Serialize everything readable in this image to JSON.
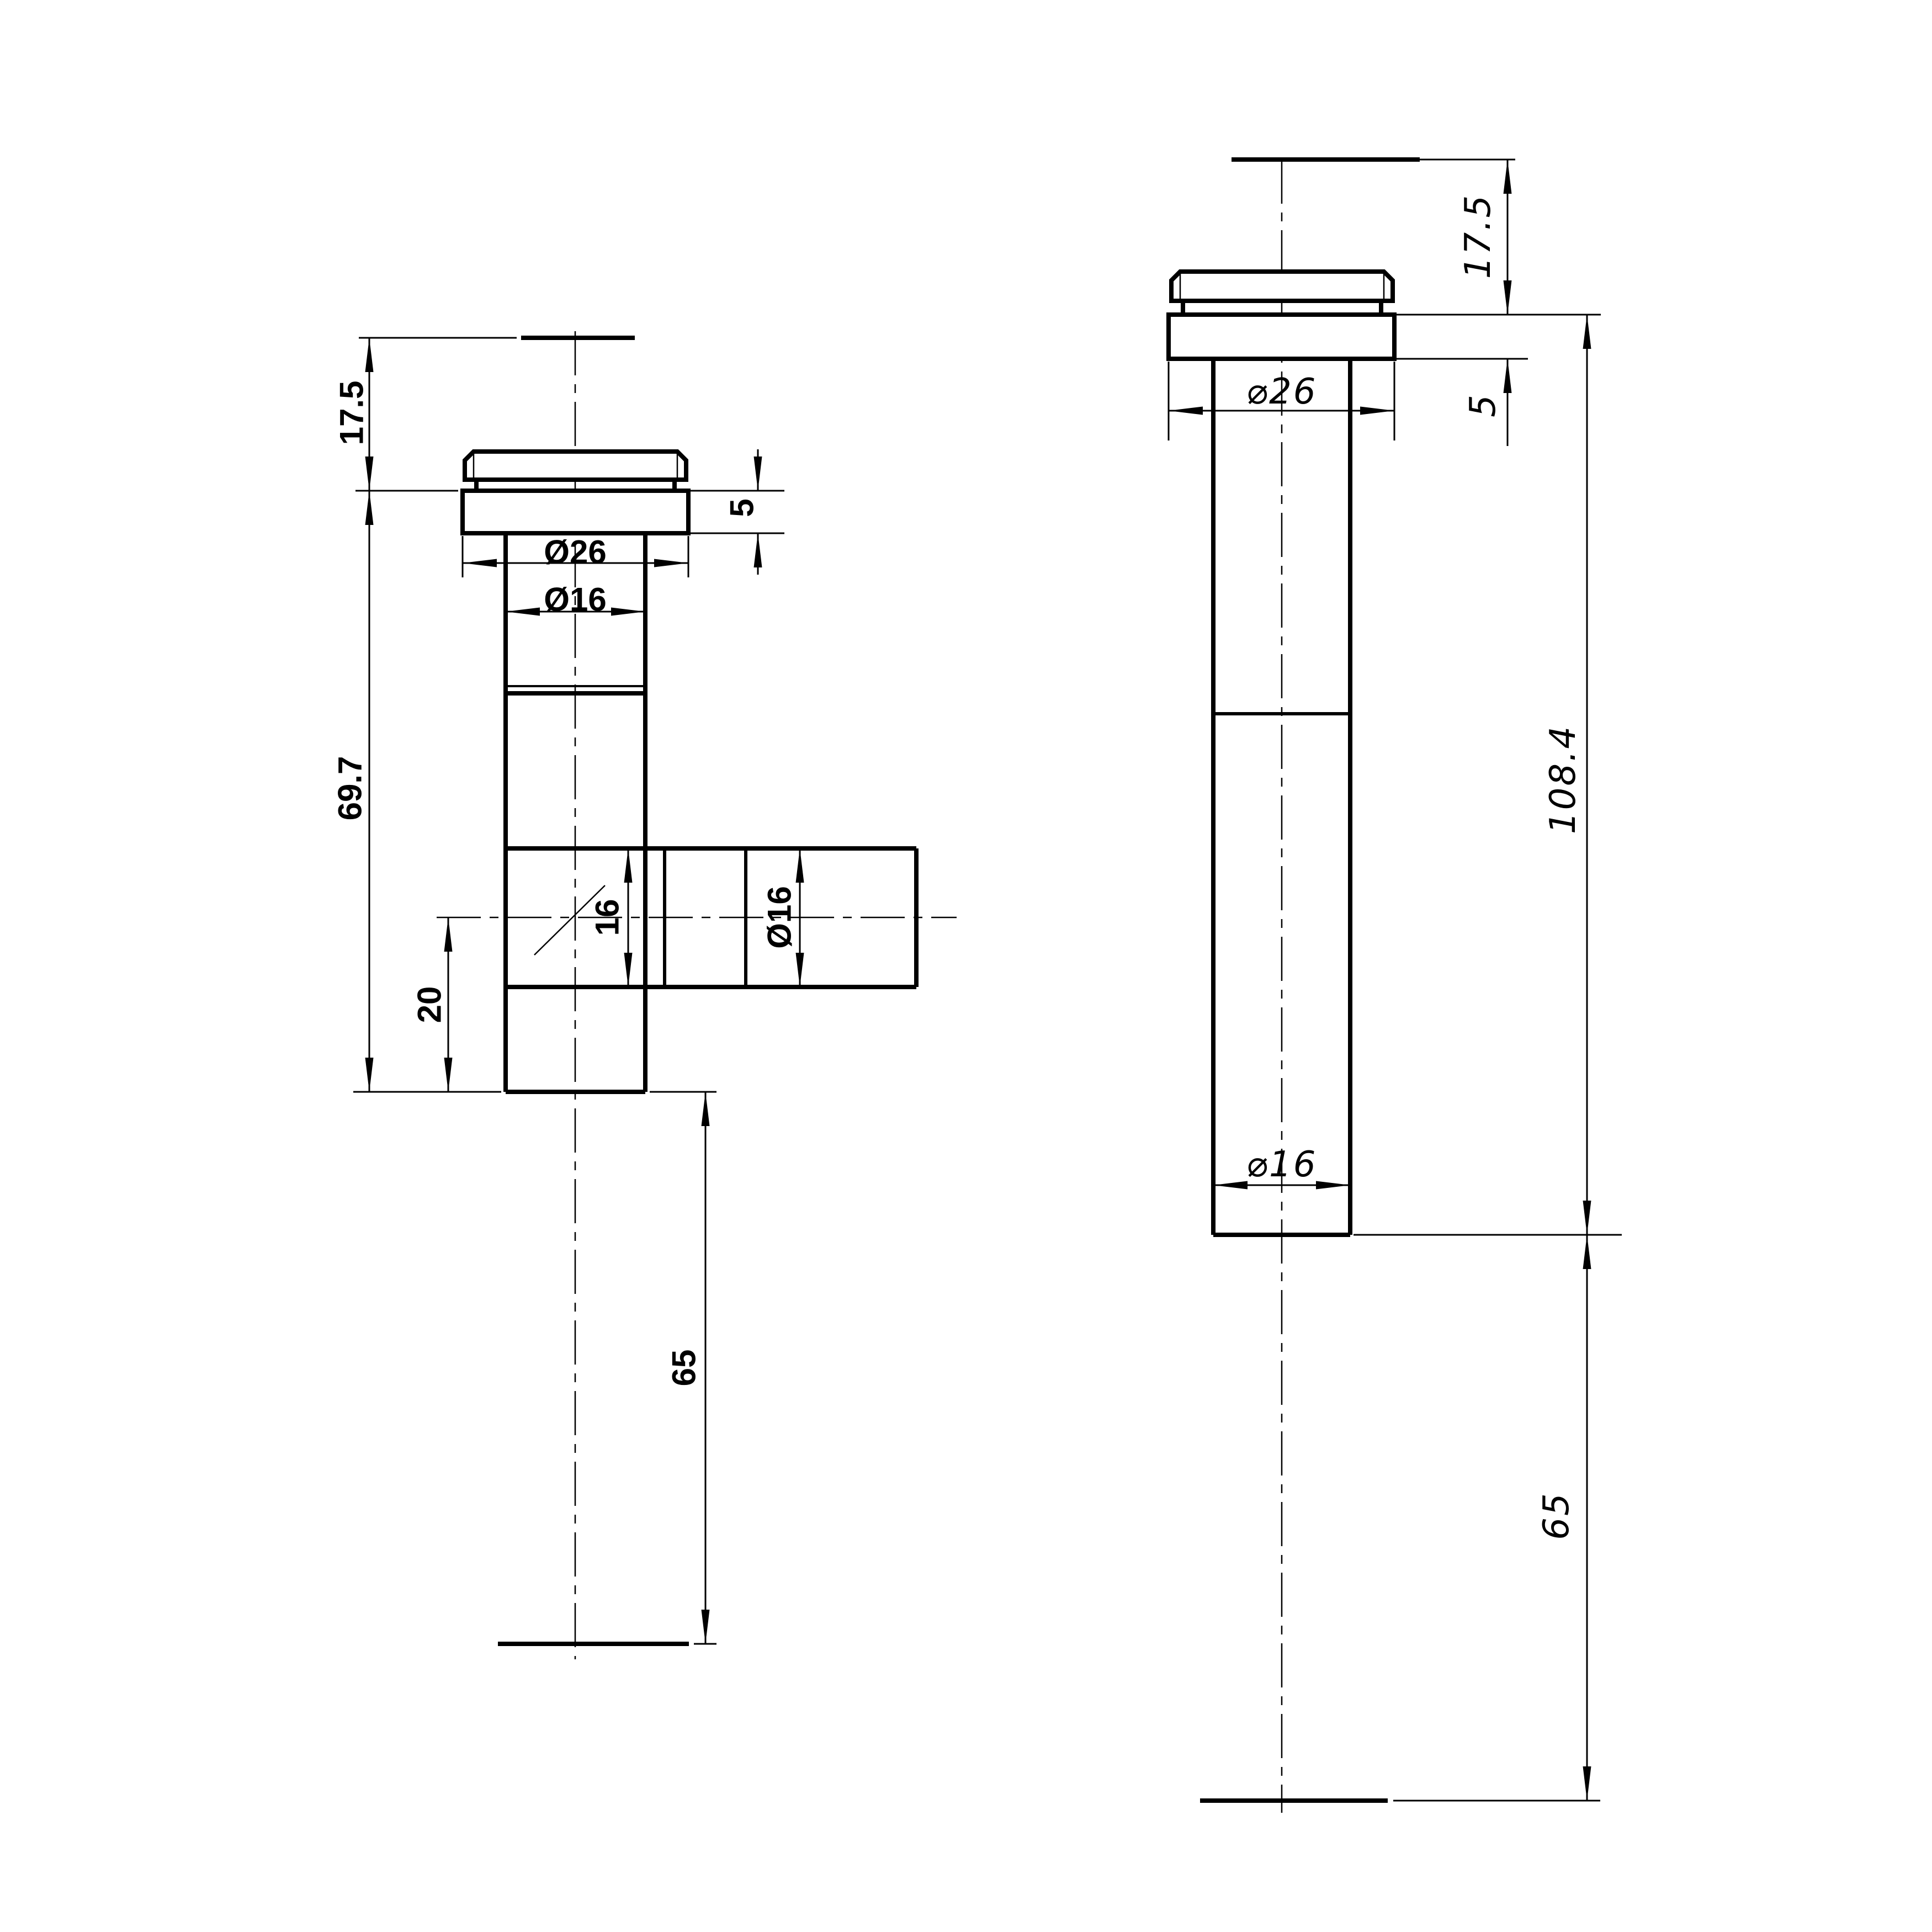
{
  "drawing": {
    "background": "#ffffff",
    "line_color": "#000000",
    "views": {
      "front": {
        "name": "front view with side branch",
        "labels": {
          "top_offset": "17.5",
          "body_length": "69.7",
          "flange_thickness": "5",
          "flange_diameter": "Ø26",
          "pipe_diameter": "Ø16",
          "branch_bore": "16",
          "branch_diameter": "Ø16",
          "branch_center_offset": "20",
          "outlet_extension": "65"
        }
      },
      "side": {
        "name": "side view straight pipe",
        "labels": {
          "top_offset": "17.5",
          "flange_thickness": "5",
          "flange_diameter": "⌀26",
          "overall_length": "108.4",
          "pipe_diameter": "⌀16",
          "outlet_extension": "65"
        }
      }
    }
  }
}
